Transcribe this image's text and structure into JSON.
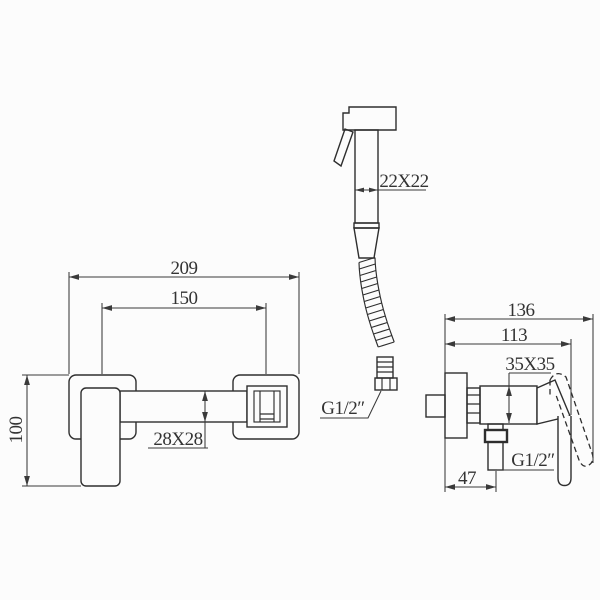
{
  "drawing": {
    "background_color": "#fcfcfc",
    "line_color": "#2e2e2e",
    "views": {
      "front_view": {
        "dim_overall_width": "209",
        "dim_mount_spacing": "150",
        "dim_overall_height": "100",
        "dim_crossbar_section": "28X28"
      },
      "hand_sprayer": {
        "dim_head_section": "22X22",
        "hose_thread_label": "G1/2″"
      },
      "side_view": {
        "dim_overall_depth": "136",
        "dim_body_depth": "113",
        "dim_body_section": "35X35",
        "outlet_thread_label": "G1/2″",
        "dim_outlet_offset": "47"
      }
    }
  }
}
